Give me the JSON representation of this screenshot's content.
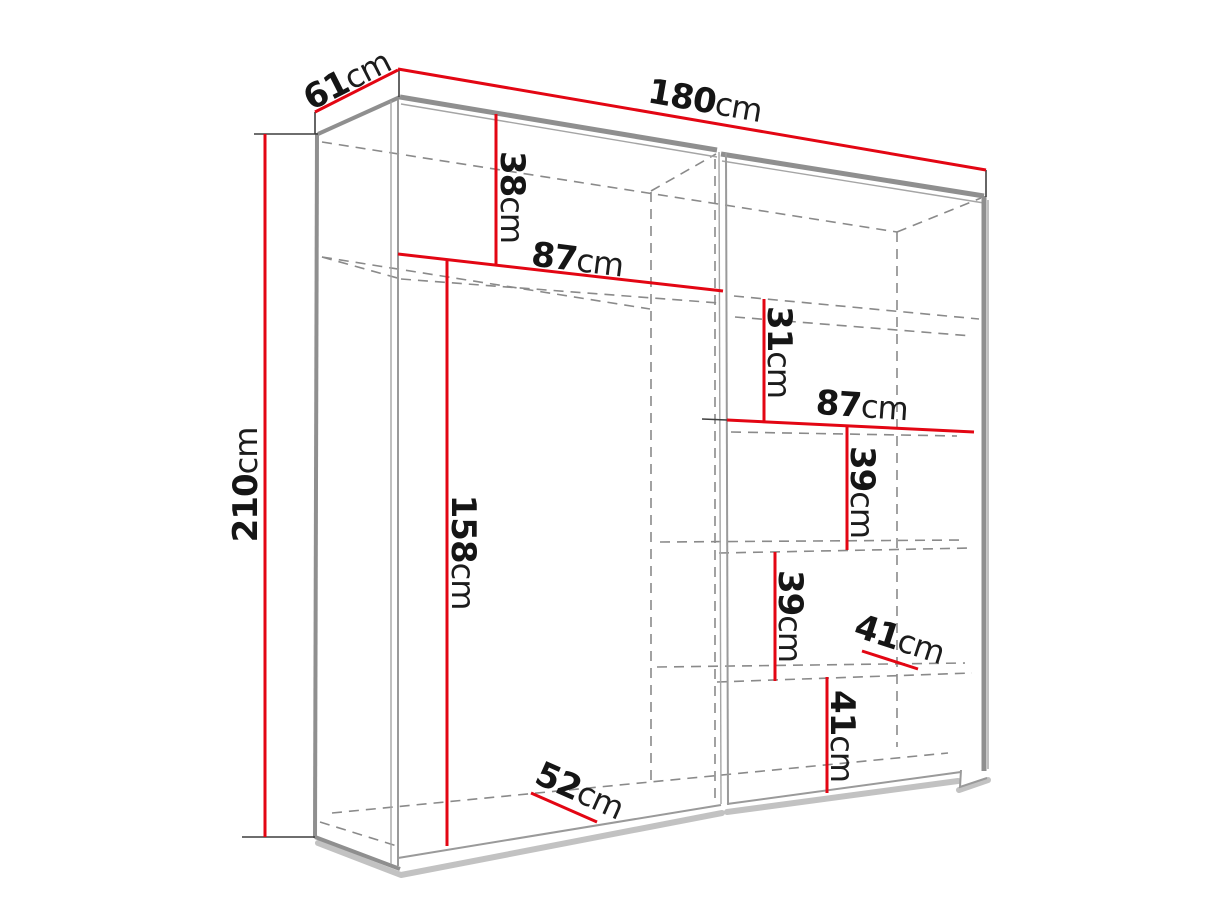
{
  "diagram": {
    "title": "wardrobe-dimension-diagram",
    "colors": {
      "dimension_red": "#e30613",
      "structure_gray": "#8f8f8f",
      "dashed_gray": "#8a8a8a",
      "tick_black": "#3f3f3f",
      "text_black": "#151515",
      "shadow_gray": "#c2c2c2",
      "background": "#ffffff"
    },
    "dimensions": {
      "depth": {
        "value": "61",
        "unit": "cm"
      },
      "width": {
        "value": "180",
        "unit": "cm"
      },
      "height": {
        "value": "210",
        "unit": "cm"
      },
      "top_shelf_drop": {
        "value": "38",
        "unit": "cm"
      },
      "left_section_width": {
        "value": "87",
        "unit": "cm"
      },
      "hanging_height": {
        "value": "158",
        "unit": "cm"
      },
      "right_top_gap": {
        "value": "31",
        "unit": "cm"
      },
      "right_section_width": {
        "value": "87",
        "unit": "cm"
      },
      "shelf_gap_upper": {
        "value": "39",
        "unit": "cm"
      },
      "shelf_gap_middle": {
        "value": "39",
        "unit": "cm"
      },
      "shelf_depth": {
        "value": "41",
        "unit": "cm"
      },
      "bottom_gap": {
        "value": "41",
        "unit": "cm"
      },
      "interior_depth": {
        "value": "52",
        "unit": "cm"
      }
    }
  }
}
